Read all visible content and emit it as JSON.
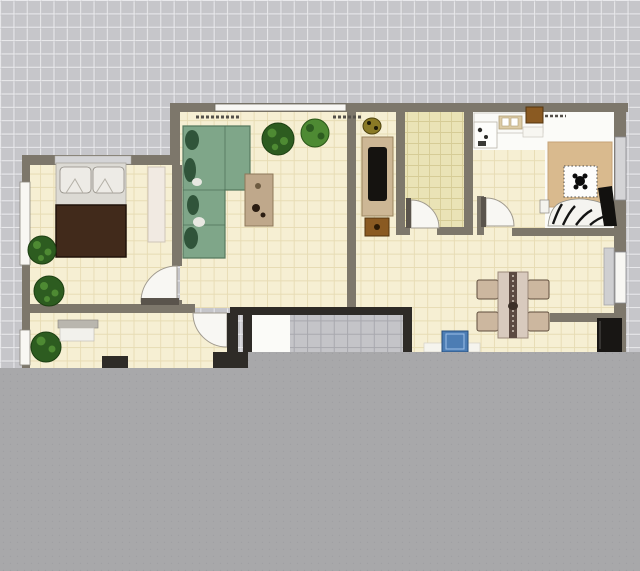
{
  "scene": {
    "type": "floor-plan-viewport",
    "description": "Top-down apartment floor plan on a gray drafting grid; lower portion of viewport is covered by a flat gray panel",
    "grid_visible": true
  },
  "palette": {
    "grid_bg": "#c6c6ca",
    "grid_line": "#e9e9ec",
    "grid_line_dark": "#b9b9bd",
    "overlay": "#a8a8aa",
    "overlay_dot": "#98989b",
    "wall": "#7d776b",
    "wall_dark": "#2e2b27",
    "door_leaf": "#5a544c",
    "floor_cream": "#f6efd3",
    "floor_cream_line": "#e7dcb4",
    "floor_green": "#eae3b6",
    "floor_green_line": "#d6cc96",
    "bath_tile": "#c4c4c8",
    "bath_tile_line": "#a8a8ae",
    "white_floor": "#fbfbf8",
    "window_white": "#f8f7f3",
    "window_gray": "#d4d4d6",
    "sofa": "#7fa689",
    "sofa_dark": "#30543a",
    "sofa_pillow": "#e8e8e2",
    "bed": "#412a1b",
    "headboard": "#dcdad4",
    "pillow": "#edebe6",
    "rug_bedroom": "#f1eae2",
    "rug_sitting": "#d9ba8e",
    "plant": "#2d5c20",
    "plant_light": "#4e8a33",
    "coffee_table": "#bfa88b",
    "tv_cabinet": "#cdb795",
    "tv": "#151310",
    "brown_box": "#8a5a22",
    "counter": "#fafaf7",
    "counter_gray": "#cfcfd1",
    "stove": "#ddcca6",
    "chair": "#ccb79f",
    "dining_table": "#d8cabe",
    "table_runner": "#5c4a42",
    "sink_blue": "#4c7db4",
    "fridge": "#181614",
    "zebra_white": "#f5f4f0",
    "zebra_black": "#141414",
    "frame_white": "#fdfdfc",
    "ornament_black": "#0c0c0c",
    "pot_olive": "#8a7a26"
  },
  "rooms": [
    {
      "id": "bedroom",
      "contents": [
        "double-bed",
        "headboard-pillows",
        "area-rug",
        "potted-plant",
        "potted-plant",
        "window"
      ]
    },
    {
      "id": "living-room",
      "contents": [
        "l-shaped-sofa",
        "coffee-table",
        "potted-plant",
        "potted-plant",
        "window"
      ]
    },
    {
      "id": "tv-nook",
      "contents": [
        "tv-cabinet",
        "television",
        "media-box",
        "potted-item"
      ]
    },
    {
      "id": "storage-room",
      "contents": [
        "tiled-floor",
        "door"
      ]
    },
    {
      "id": "kitchen",
      "contents": [
        "counter",
        "sink",
        "stove",
        "shelf-box",
        "door"
      ]
    },
    {
      "id": "sitting-room",
      "contents": [
        "area-rug",
        "display-table",
        "ornament",
        "zebra-lounge",
        "window"
      ]
    },
    {
      "id": "dining-area",
      "contents": [
        "dining-table",
        "chair",
        "chair",
        "chair",
        "chair",
        "blue-sink",
        "fridge",
        "side-counter",
        "window"
      ]
    },
    {
      "id": "bathroom",
      "contents": [
        "gray-tiles",
        "dark-walls",
        "door"
      ]
    },
    {
      "id": "lower-room",
      "contents": [
        "potted-plant",
        "cabinet",
        "window"
      ]
    }
  ],
  "overlay_panel": {
    "covers": "bottom of viewport",
    "texture": "fine dot grid"
  }
}
